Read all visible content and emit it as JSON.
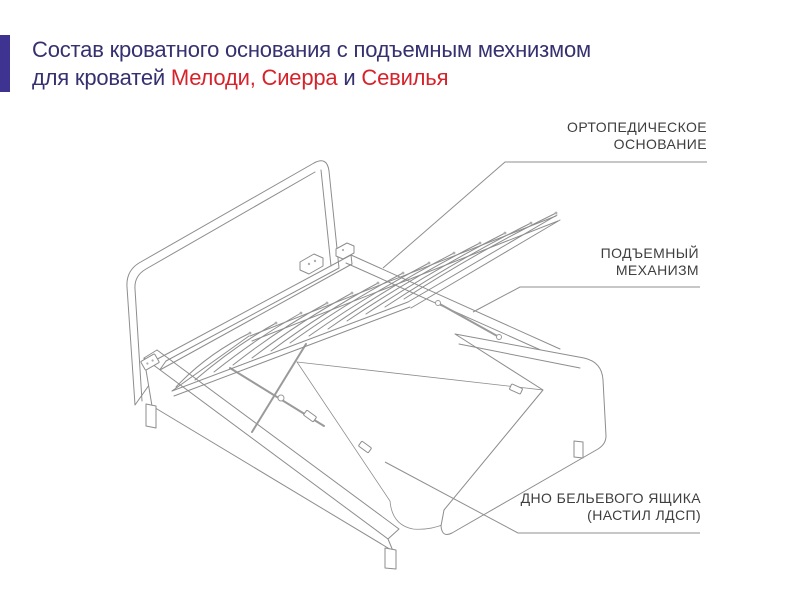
{
  "title": {
    "line1": "Состав кроватного основания с подъемным мехнизмом",
    "line2_pre": "для кроватей ",
    "line2_red1": "Мелоди, Сиерра",
    "line2_and": " и ",
    "line2_red2": "Севилья"
  },
  "callouts": {
    "orthopedic_base": {
      "line1": "ОРТОПЕДИЧЕСКОЕ",
      "line2": "ОСНОВАНИЕ"
    },
    "lift_mechanism": {
      "line1": "ПОДЪЕМНЫЙ",
      "line2": "МЕХАНИЗМ"
    },
    "drawer_bottom": {
      "line1": "ДНО БЕЛЬЕВОГО ЯЩИКА",
      "line2": "(НАСТИЛ ЛДСП)"
    }
  },
  "colors": {
    "accent_bar": "#3f3391",
    "title_text": "#35306f",
    "highlight_red": "#d6232b",
    "callout_text": "#3e3e3e",
    "line_art": "#8d8d8d",
    "panel_fill_dark": "#c8cdd5",
    "panel_fill_light": "#dfe2e6"
  }
}
